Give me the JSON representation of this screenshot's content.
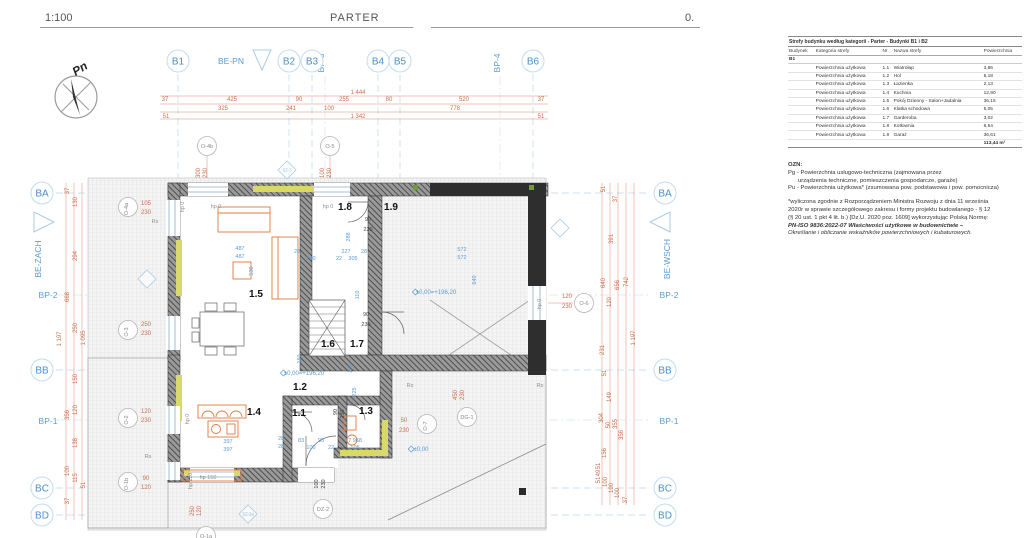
{
  "header": {
    "scale": "1:100",
    "title": "PARTER",
    "page": "0."
  },
  "compass": {
    "label": "Pn"
  },
  "panel": {
    "table": {
      "title": "Strefy budynku według kategorii - Parter - Budynki B1 i B2",
      "columns": [
        "Budynek",
        "Kategoria strefy",
        "Nr",
        "Nazwa strefy",
        "Powierzchnia"
      ],
      "group": "B1",
      "rows": [
        {
          "kat": "Powierzchnia użytkowa",
          "nr": "1.1",
          "name": "Wiatrołap",
          "area": "3,86"
        },
        {
          "kat": "Powierzchnia użytkowa",
          "nr": "1.2",
          "name": "Hol",
          "area": "5,18"
        },
        {
          "kat": "Powierzchnia użytkowa",
          "nr": "1.3",
          "name": "Łazienka",
          "area": "2,13"
        },
        {
          "kat": "Powierzchnia użytkowa",
          "nr": "1.4",
          "name": "Kuchnia",
          "area": "12,90"
        },
        {
          "kat": "Powierzchnia użytkowa",
          "nr": "1.5",
          "name": "Pokój Dzienny - Salon+Jadalnia",
          "area": "36,15"
        },
        {
          "kat": "Powierzchnia użytkowa",
          "nr": "1.6",
          "name": "Klatka schodowa",
          "area": "5,05"
        },
        {
          "kat": "Powierzchnia użytkowa",
          "nr": "1.7",
          "name": "Garderoba",
          "area": "3,02"
        },
        {
          "kat": "Powierzchnia użytkowa",
          "nr": "1.8",
          "name": "Kotłownia",
          "area": "8,54"
        },
        {
          "kat": "Powierzchnia użytkowa",
          "nr": "1.9",
          "name": "Garaż",
          "area": "36,61"
        }
      ],
      "total": "113,44 m²"
    },
    "notes": [
      {
        "t": "OZN:",
        "cls": "b"
      },
      {
        "t": "Pg - Powierzchnia usługowo-techniczna (zajmowana przez",
        "cls": ""
      },
      {
        "t": "urządzenia techniczne, pomieszczenia gospodarcze, garaże)",
        "cls": "ind"
      },
      {
        "t": "Pu - Powierzchnia użytkowa* (zsumowana pow. podstawowa i pow. pomocnicza)",
        "cls": ""
      },
      {
        "t": "",
        "cls": "gap"
      },
      {
        "t": "*wyliczona zgodnie z Rozporządzeniem Ministra Rozwoju z dnia 11 września",
        "cls": ""
      },
      {
        "t": "2020r w sprawie szczegółowego zakresu i formy projektu budowlanego - § 12",
        "cls": ""
      },
      {
        "t": "(§ 20 ust. 1 pkt 4 lit. b.) [Dz.U. 2020 poz. 1609] wykorzystując Polską Normę:",
        "cls": ""
      },
      {
        "t": "PN-ISO 9836:2022-07 Właściwości użytkowe w budownictwie –",
        "cls": "pn"
      },
      {
        "t": "Określanie i obliczanie wskaźników powierzchniowych i kubaturowych.",
        "cls": "it"
      }
    ]
  },
  "plan": {
    "bubbles": [
      {
        "t": "B1",
        "x": 178,
        "y": 61
      },
      {
        "t": "B2",
        "x": 289,
        "y": 61
      },
      {
        "t": "B3",
        "x": 312,
        "y": 61
      },
      {
        "t": "B4",
        "x": 378,
        "y": 61
      },
      {
        "t": "B5",
        "x": 400,
        "y": 61
      },
      {
        "t": "B6",
        "x": 533,
        "y": 61
      },
      {
        "t": "BA",
        "x": 42,
        "y": 193
      },
      {
        "t": "BB",
        "x": 42,
        "y": 370
      },
      {
        "t": "BC",
        "x": 42,
        "y": 488
      },
      {
        "t": "BD",
        "x": 42,
        "y": 515
      },
      {
        "t": "BA",
        "x": 665,
        "y": 193
      },
      {
        "t": "BB",
        "x": 665,
        "y": 370
      },
      {
        "t": "BC",
        "x": 665,
        "y": 488
      },
      {
        "t": "BD",
        "x": 665,
        "y": 515
      }
    ],
    "sections": [
      {
        "t": "BE-PN",
        "x": 231,
        "y": 64
      },
      {
        "t": "BP-3",
        "x": 324,
        "y": 63,
        "r": -90
      },
      {
        "t": "BP-4",
        "x": 500,
        "y": 63,
        "r": -90
      },
      {
        "t": "BE-ZACH",
        "x": 41,
        "y": 259,
        "r": -90
      },
      {
        "t": "BE-WSCH",
        "x": 670,
        "y": 259,
        "r": -90
      },
      {
        "t": "BP-2",
        "x": 48,
        "y": 298
      },
      {
        "t": "BP-1",
        "x": 48,
        "y": 424
      },
      {
        "t": "BP-2",
        "x": 669,
        "y": 298
      },
      {
        "t": "BP-1",
        "x": 669,
        "y": 424
      }
    ],
    "rooms": [
      {
        "t": "1.1",
        "x": 299,
        "y": 416
      },
      {
        "t": "1.2",
        "x": 300,
        "y": 390
      },
      {
        "t": "1.3",
        "x": 366,
        "y": 414
      },
      {
        "t": "1.4",
        "x": 254,
        "y": 415
      },
      {
        "t": "1.5",
        "x": 256,
        "y": 297
      },
      {
        "t": "1.6",
        "x": 328,
        "y": 347
      },
      {
        "t": "1.7",
        "x": 357,
        "y": 347
      },
      {
        "t": "1.8",
        "x": 345,
        "y": 210
      },
      {
        "t": "1.9",
        "x": 391,
        "y": 210
      }
    ],
    "openings": [
      {
        "t": "O-4b",
        "x": 207,
        "y": 146
      },
      {
        "t": "O-5",
        "x": 330,
        "y": 146
      },
      {
        "t": "O-4a",
        "x": 128,
        "y": 207,
        "r": -90
      },
      {
        "t": "O-3",
        "x": 128,
        "y": 330,
        "r": -90
      },
      {
        "t": "O-2",
        "x": 128,
        "y": 418,
        "r": -90
      },
      {
        "t": "O-1b",
        "x": 128,
        "y": 482,
        "r": -90
      },
      {
        "t": "O-6",
        "x": 584,
        "y": 303
      },
      {
        "t": "O-7",
        "x": 427,
        "y": 424,
        "r": -90
      },
      {
        "t": "DG-1",
        "x": 467,
        "y": 417
      },
      {
        "t": "DZ-2",
        "x": 323,
        "y": 509
      },
      {
        "t": "O-1a",
        "x": 206,
        "y": 536
      }
    ],
    "diamonds": [
      {
        "t": "SZ-3",
        "x": 287,
        "y": 170
      },
      {
        "t": "SZ-2a",
        "x": 248,
        "y": 514
      },
      {
        "t": "",
        "x": 560,
        "y": 228
      },
      {
        "t": "",
        "x": 147,
        "y": 279
      }
    ],
    "texts": [
      {
        "t": "1 444",
        "x": 358,
        "y": 94,
        "c": "dim"
      },
      {
        "t": "37",
        "x": 165,
        "y": 101,
        "c": "dim"
      },
      {
        "t": "425",
        "x": 232,
        "y": 101,
        "c": "dim"
      },
      {
        "t": "90",
        "x": 299,
        "y": 101,
        "c": "dim"
      },
      {
        "t": "255",
        "x": 344,
        "y": 101,
        "c": "dim"
      },
      {
        "t": "80",
        "x": 389,
        "y": 101,
        "c": "dim"
      },
      {
        "t": "520",
        "x": 464,
        "y": 101,
        "c": "dim"
      },
      {
        "t": "37",
        "x": 541,
        "y": 101,
        "c": "dim"
      },
      {
        "t": "325",
        "x": 223,
        "y": 110,
        "c": "dim"
      },
      {
        "t": "241",
        "x": 291,
        "y": 110,
        "c": "dim"
      },
      {
        "t": "100",
        "x": 329,
        "y": 110,
        "c": "dim"
      },
      {
        "t": "778",
        "x": 455,
        "y": 110,
        "c": "dim"
      },
      {
        "t": "51",
        "x": 166,
        "y": 118,
        "c": "dim"
      },
      {
        "t": "1 342",
        "x": 358,
        "y": 118,
        "c": "dim"
      },
      {
        "t": "51",
        "x": 541,
        "y": 118,
        "c": "dim"
      },
      {
        "t": "37",
        "x": 69,
        "y": 191,
        "c": "dim",
        "r": -90
      },
      {
        "t": "130",
        "x": 77,
        "y": 202,
        "c": "dim",
        "r": -90
      },
      {
        "t": "294",
        "x": 77,
        "y": 256,
        "c": "dim",
        "r": -90
      },
      {
        "t": "668",
        "x": 69,
        "y": 297,
        "c": "dim",
        "r": -90
      },
      {
        "t": "250",
        "x": 77,
        "y": 328,
        "c": "dim",
        "r": -90
      },
      {
        "t": "1 197",
        "x": 61,
        "y": 339,
        "c": "dim",
        "r": -90
      },
      {
        "t": "1 095",
        "x": 85,
        "y": 338,
        "c": "dim",
        "r": -90
      },
      {
        "t": "150",
        "x": 77,
        "y": 379,
        "c": "dim",
        "r": -90
      },
      {
        "t": "120",
        "x": 77,
        "y": 410,
        "c": "dim",
        "r": -90
      },
      {
        "t": "356",
        "x": 69,
        "y": 415,
        "c": "dim",
        "r": -90
      },
      {
        "t": "138",
        "x": 77,
        "y": 443,
        "c": "dim",
        "r": -90
      },
      {
        "t": "100",
        "x": 69,
        "y": 471,
        "c": "dim",
        "r": -90
      },
      {
        "t": "115",
        "x": 77,
        "y": 478,
        "c": "dim",
        "r": -90
      },
      {
        "t": "51",
        "x": 85,
        "y": 485,
        "c": "dim",
        "r": -90
      },
      {
        "t": "37",
        "x": 69,
        "y": 501,
        "c": "dim",
        "r": -90
      },
      {
        "t": "51",
        "x": 605,
        "y": 189,
        "c": "dim",
        "r": -90
      },
      {
        "t": "37",
        "x": 617,
        "y": 199,
        "c": "dim",
        "r": -90
      },
      {
        "t": "391",
        "x": 613,
        "y": 239,
        "c": "dim",
        "r": -90
      },
      {
        "t": "640",
        "x": 605,
        "y": 283,
        "c": "dim",
        "r": -90
      },
      {
        "t": "656",
        "x": 619,
        "y": 285,
        "c": "dim",
        "r": -90
      },
      {
        "t": "742",
        "x": 628,
        "y": 282,
        "c": "dim",
        "r": -90
      },
      {
        "t": "120",
        "x": 611,
        "y": 302,
        "c": "dim",
        "r": -90
      },
      {
        "t": "1 197",
        "x": 635,
        "y": 338,
        "c": "dim",
        "r": -90
      },
      {
        "t": "231",
        "x": 604,
        "y": 350,
        "c": "dim",
        "r": -90
      },
      {
        "t": "51",
        "x": 606,
        "y": 373,
        "c": "dim",
        "r": -90
      },
      {
        "t": "149",
        "x": 611,
        "y": 397,
        "c": "dim",
        "r": -90
      },
      {
        "t": "304",
        "x": 603,
        "y": 418,
        "c": "dim",
        "r": -90
      },
      {
        "t": "50",
        "x": 610,
        "y": 425,
        "c": "dim",
        "r": -90
      },
      {
        "t": "355",
        "x": 617,
        "y": 424,
        "c": "dim",
        "r": -90
      },
      {
        "t": "356",
        "x": 623,
        "y": 435,
        "c": "dim",
        "r": -90
      },
      {
        "t": "156",
        "x": 606,
        "y": 453,
        "c": "dim",
        "r": -90
      },
      {
        "t": "51",
        "x": 600,
        "y": 466,
        "c": "dim",
        "r": -90
      },
      {
        "t": "49",
        "x": 600,
        "y": 473,
        "c": "dim",
        "r": -90
      },
      {
        "t": "51",
        "x": 600,
        "y": 480,
        "c": "dim",
        "r": -90
      },
      {
        "t": "100",
        "x": 607,
        "y": 482,
        "c": "dim",
        "r": -90
      },
      {
        "t": "100",
        "x": 613,
        "y": 488,
        "c": "dim",
        "r": -90
      },
      {
        "t": "100",
        "x": 619,
        "y": 493,
        "c": "dim",
        "r": -90
      },
      {
        "t": "37",
        "x": 627,
        "y": 500,
        "c": "dim",
        "r": -90
      },
      {
        "t": "300",
        "x": 200,
        "y": 173,
        "c": "dim",
        "r": -90
      },
      {
        "t": "230",
        "x": 207,
        "y": 173,
        "c": "dim",
        "r": -90
      },
      {
        "t": "100",
        "x": 324,
        "y": 173,
        "c": "dim",
        "r": -90
      },
      {
        "t": "230",
        "x": 331,
        "y": 173,
        "c": "dim",
        "r": -90
      },
      {
        "t": "105",
        "x": 146,
        "y": 205,
        "c": "dim"
      },
      {
        "t": "230",
        "x": 146,
        "y": 214,
        "c": "dim"
      },
      {
        "t": "250",
        "x": 146,
        "y": 326,
        "c": "dim"
      },
      {
        "t": "230",
        "x": 146,
        "y": 335,
        "c": "dim"
      },
      {
        "t": "120",
        "x": 146,
        "y": 413,
        "c": "dim"
      },
      {
        "t": "230",
        "x": 146,
        "y": 422,
        "c": "dim"
      },
      {
        "t": "90",
        "x": 146,
        "y": 480,
        "c": "dim"
      },
      {
        "t": "120",
        "x": 146,
        "y": 489,
        "c": "dim"
      },
      {
        "t": "120",
        "x": 567,
        "y": 298,
        "c": "dim"
      },
      {
        "t": "230",
        "x": 567,
        "y": 308,
        "c": "dim"
      },
      {
        "t": "50",
        "x": 404,
        "y": 422,
        "c": "dim"
      },
      {
        "t": "230",
        "x": 404,
        "y": 432,
        "c": "dim"
      },
      {
        "t": "450",
        "x": 457,
        "y": 395,
        "c": "dim",
        "r": -90
      },
      {
        "t": "230",
        "x": 464,
        "y": 395,
        "c": "dim",
        "r": -90
      },
      {
        "t": "250",
        "x": 194,
        "y": 511,
        "c": "dim",
        "r": -90
      },
      {
        "t": "120",
        "x": 201,
        "y": 511,
        "c": "dim",
        "r": -90
      },
      {
        "t": "90",
        "x": 368,
        "y": 221,
        "c": "blk"
      },
      {
        "t": "230",
        "x": 368,
        "y": 231,
        "c": "blk"
      },
      {
        "t": "90",
        "x": 366,
        "y": 316,
        "c": "blk"
      },
      {
        "t": "230",
        "x": 366,
        "y": 326,
        "c": "blk"
      },
      {
        "t": "90",
        "x": 337,
        "y": 412,
        "c": "blk",
        "r": -90
      },
      {
        "t": "230",
        "x": 344,
        "y": 414,
        "c": "blk",
        "r": -90
      },
      {
        "t": "100",
        "x": 318,
        "y": 484,
        "c": "blk",
        "r": -90
      },
      {
        "t": "230",
        "x": 325,
        "y": 484,
        "c": "blk",
        "r": -90
      },
      {
        "t": "Rs",
        "x": 155,
        "y": 223,
        "c": "gry"
      },
      {
        "t": "Rs",
        "x": 148,
        "y": 458,
        "c": "gry"
      },
      {
        "t": "Rs",
        "x": 410,
        "y": 387,
        "c": "gry"
      },
      {
        "t": "Rs",
        "x": 540,
        "y": 387,
        "c": "gry"
      },
      {
        "t": "hp 0",
        "x": 184,
        "y": 207,
        "c": "gry",
        "r": -90
      },
      {
        "t": "hp 0",
        "x": 216,
        "y": 208,
        "c": "gry"
      },
      {
        "t": "hp 0",
        "x": 328,
        "y": 208,
        "c": "gry"
      },
      {
        "t": "hp 0",
        "x": 189,
        "y": 419,
        "c": "gry",
        "r": -90
      },
      {
        "t": "hp 110",
        "x": 192,
        "y": 481,
        "c": "gry",
        "r": -90
      },
      {
        "t": "hp 150",
        "x": 208,
        "y": 479,
        "c": "gry"
      },
      {
        "t": "hp 0",
        "x": 541,
        "y": 304,
        "c": "gry",
        "r": -90
      },
      {
        "t": "487",
        "x": 240,
        "y": 250,
        "c": "blu"
      },
      {
        "t": "487",
        "x": 240,
        "y": 258,
        "c": "blu"
      },
      {
        "t": "530",
        "x": 253,
        "y": 271,
        "c": "blu",
        "r": -90
      },
      {
        "t": "28",
        "x": 297,
        "y": 253,
        "c": "blu"
      },
      {
        "t": "100",
        "x": 311,
        "y": 260,
        "c": "blu"
      },
      {
        "t": "227",
        "x": 346,
        "y": 253,
        "c": "blu"
      },
      {
        "t": "22",
        "x": 339,
        "y": 260,
        "c": "blu"
      },
      {
        "t": "305",
        "x": 353,
        "y": 260,
        "c": "blu"
      },
      {
        "t": "28",
        "x": 364,
        "y": 253,
        "c": "blu"
      },
      {
        "t": "572",
        "x": 462,
        "y": 251,
        "c": "blu"
      },
      {
        "t": "572",
        "x": 462,
        "y": 259,
        "c": "blu"
      },
      {
        "t": "640",
        "x": 476,
        "y": 280,
        "c": "blu",
        "r": -90
      },
      {
        "t": "288",
        "x": 350,
        "y": 237,
        "c": "blu",
        "r": -90
      },
      {
        "t": "110",
        "x": 359,
        "y": 295,
        "c": "blu",
        "r": -90
      },
      {
        "t": "150",
        "x": 301,
        "y": 359,
        "c": "blu",
        "r": -90
      },
      {
        "t": "210",
        "x": 352,
        "y": 368,
        "c": "blu",
        "r": -90
      },
      {
        "t": "225",
        "x": 356,
        "y": 392,
        "c": "blu",
        "r": -90
      },
      {
        "t": "397",
        "x": 228,
        "y": 443,
        "c": "blu"
      },
      {
        "t": "397",
        "x": 228,
        "y": 451,
        "c": "blu"
      },
      {
        "t": "28",
        "x": 281,
        "y": 440,
        "c": "blu"
      },
      {
        "t": "28",
        "x": 281,
        "y": 448,
        "c": "blu"
      },
      {
        "t": "83",
        "x": 301,
        "y": 442,
        "c": "blu"
      },
      {
        "t": "90",
        "x": 321,
        "y": 442,
        "c": "blu"
      },
      {
        "t": "100",
        "x": 311,
        "y": 449,
        "c": "blu"
      },
      {
        "t": "22",
        "x": 331,
        "y": 449,
        "c": "blu"
      },
      {
        "t": "7 968",
        "x": 355,
        "y": 442,
        "c": "blu"
      },
      {
        "t": "105",
        "x": 355,
        "y": 449,
        "c": "blu"
      },
      {
        "t": "±0,00=+196,20",
        "x": 436,
        "y": 294,
        "c": "lvl"
      },
      {
        "t": "±0,00=+196,20",
        "x": 304,
        "y": 375,
        "c": "lvl"
      },
      {
        "t": "±0,00",
        "x": 421,
        "y": 451,
        "c": "lvl"
      }
    ]
  },
  "colors": {
    "dim": "#c96f4c",
    "blue": "#5b9bd5",
    "grid": "#bcd7ec",
    "wall": "#3a3a3a",
    "insulation": "#d9d96a",
    "furniture": "#e07840"
  }
}
